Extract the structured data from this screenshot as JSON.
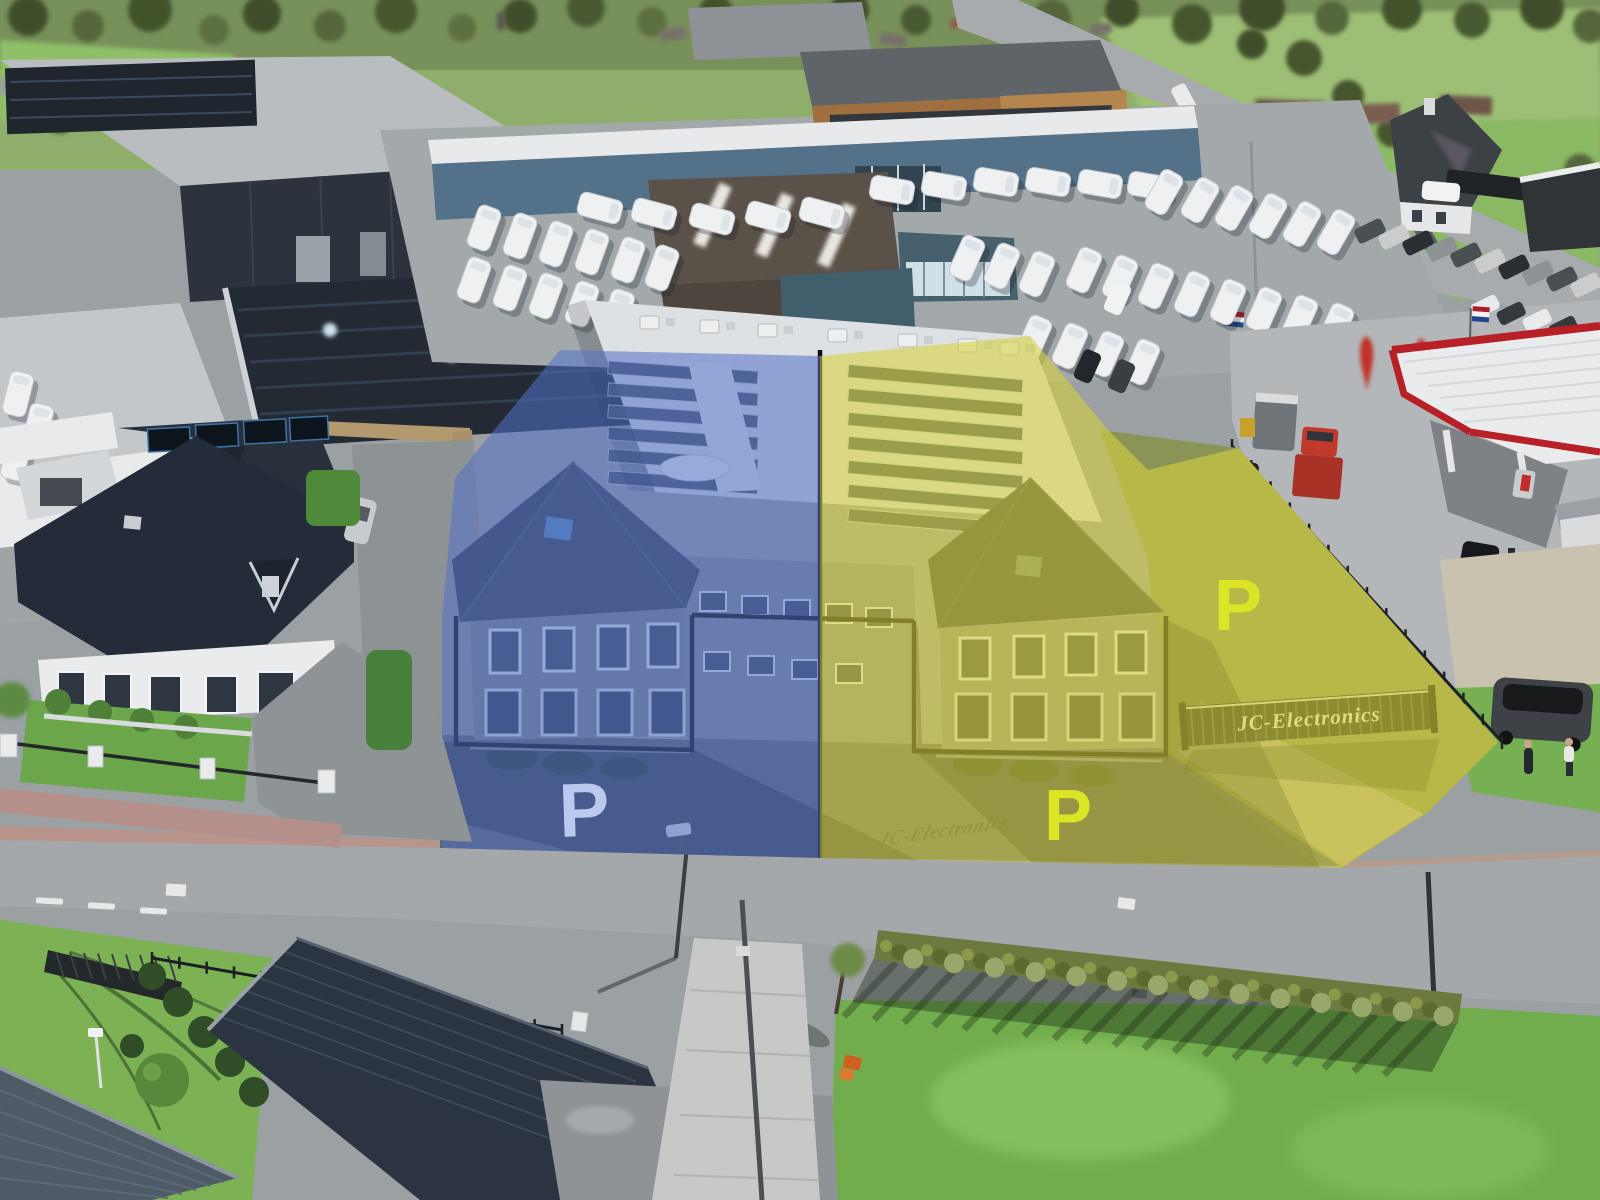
{
  "image": {
    "kind": "aerial-drone-photo",
    "subject": "industrial street with twin business units highlighted blue and yellow beside a caravan dealership and fuel station",
    "width_px": 1600,
    "height_px": 1200
  },
  "highlights": {
    "blue_unit": {
      "overlay_color": "#5271c9",
      "parking_label": "P",
      "parking_label_color": "#bac9ed"
    },
    "yellow_unit": {
      "overlay_color": "#d7d33d",
      "parking_label_field": "P",
      "parking_label_lot": "P",
      "parking_label_color": "#dce426"
    },
    "outline_color": "#0c0c0c"
  },
  "signs": {
    "gate_sign": "JC-Electronics"
  },
  "palette": {
    "road": "#a4a8ab",
    "lot_asphalt": "#a3a8ab",
    "grass_bright": "#71ad4c",
    "grass_field": "#8bb863",
    "dark_roof": "#2b3440",
    "warehouse_wall": "#2c333d",
    "dealer_wall": "#54718a",
    "canopy_red": "#b82028",
    "truck_red": "#c0392b",
    "caravan_white": "#eef0f2"
  }
}
